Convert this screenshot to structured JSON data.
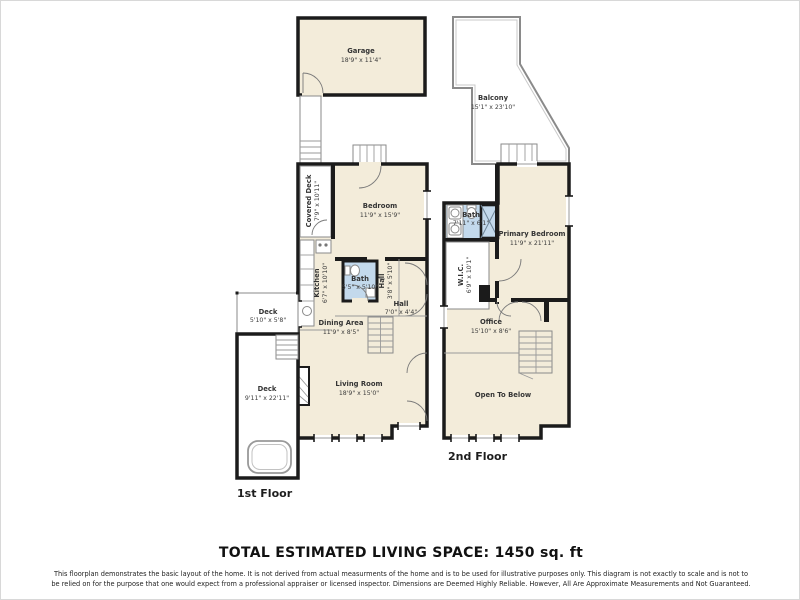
{
  "footer": {
    "total": "TOTAL ESTIMATED LIVING SPACE: 1450 sq. ft",
    "disclaimer1": "This floorplan demonstrates the basic layout of the home. It is not derived from actual measurments of the home and is to be used for illustrative purposes only. This diagram is not exactly to scale and is not to",
    "disclaimer2": "be relied on for the purpose that one would expect from a professional appraiser or licensed inspector. Dimensions are Deemed Highly Reliable. However, All Are Approximate Measurements and Not Guaranteed."
  },
  "floor1": {
    "label": "1st Floor",
    "garage": {
      "name": "Garage",
      "dims": "18'9\" x 11'4\""
    },
    "covered_deck": {
      "name": "Covered Deck",
      "dims": "7'9\" x 10'11\""
    },
    "bedroom": {
      "name": "Bedroom",
      "dims": "11'9\" x 15'9\""
    },
    "kitchen": {
      "name": "Kitchen",
      "dims": "6'7\" x 10'10\""
    },
    "bath": {
      "name": "Bath",
      "dims": "5'5\" x 5'10\""
    },
    "hall_side": {
      "name": "Hall",
      "dims": "3'8\" x 5'10\""
    },
    "hall": {
      "name": "Hall",
      "dims": "7'0\" x 4'4\""
    },
    "dining": {
      "name": "Dining Area",
      "dims": "11'9\" x 8'5\""
    },
    "deck_small": {
      "name": "Deck",
      "dims": "5'10\" x 5'8\""
    },
    "deck_large": {
      "name": "Deck",
      "dims": "9'11\" x 22'11\""
    },
    "living": {
      "name": "Living Room",
      "dims": "18'9\" x 15'0\""
    }
  },
  "floor2": {
    "label": "2nd Floor",
    "balcony": {
      "name": "Balcony",
      "dims": "15'1\" x 23'10\""
    },
    "bath": {
      "name": "Bath",
      "dims": "7'11\" x 6'1\""
    },
    "primary": {
      "name": "Primary Bedroom",
      "dims": "11'9\" x 21'11\""
    },
    "wic": {
      "name": "W.I.C.",
      "dims": "6'9\" x 10'1\""
    },
    "office": {
      "name": "Office",
      "dims": "15'10\" x 8'6\""
    },
    "open_below": {
      "name": "Open To Below"
    }
  },
  "colors": {
    "room_fill": "#f3ecda",
    "bath_fill": "#c3d9ec",
    "wall": "#1b1b1b",
    "background": "#ffffff"
  }
}
